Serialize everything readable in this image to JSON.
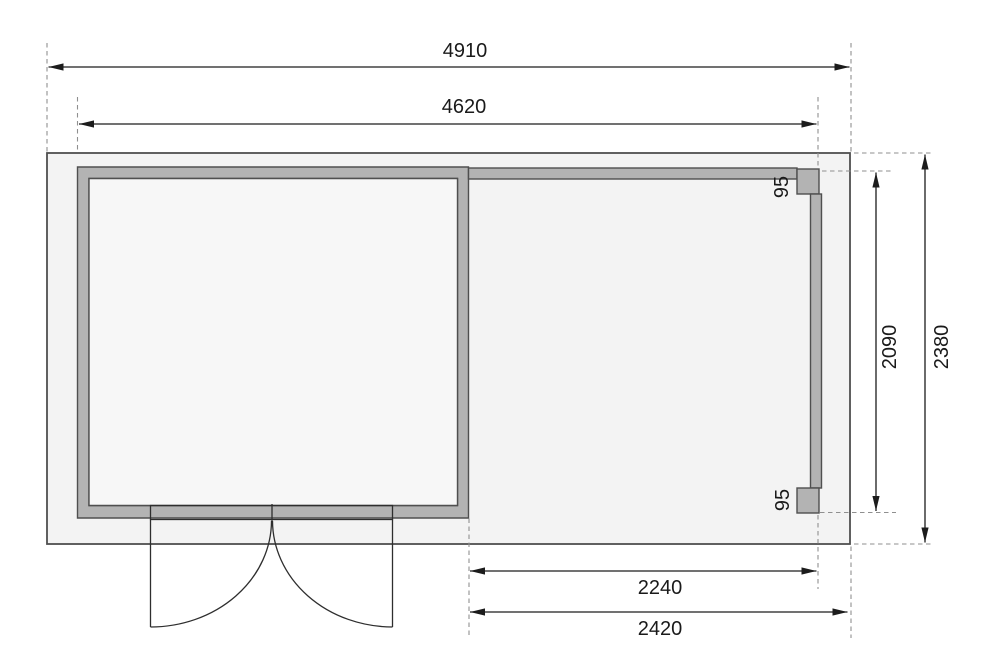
{
  "drawing": {
    "kind": "garden-house floor plan, top view, with side annex and double door",
    "units": "mm"
  },
  "dimensions": {
    "total_width": "4910",
    "house_outer_width": "4620",
    "post_size_top": "95",
    "post_size_bottom": "95",
    "annex_clear_depth": "2090",
    "total_depth": "2380",
    "annex_clear_width": "2240",
    "annex_total_width": "2420"
  },
  "colors": {
    "wall_fill": "#b3b3b3",
    "platform_fill": "#f3f3f3",
    "room_fill": "#f7f7f7",
    "door_leaf_fill": "#ffffff",
    "outline": "#4f4f4f",
    "dimension_line": "#1c1c1c",
    "extension_line": "#8f8f8f"
  }
}
